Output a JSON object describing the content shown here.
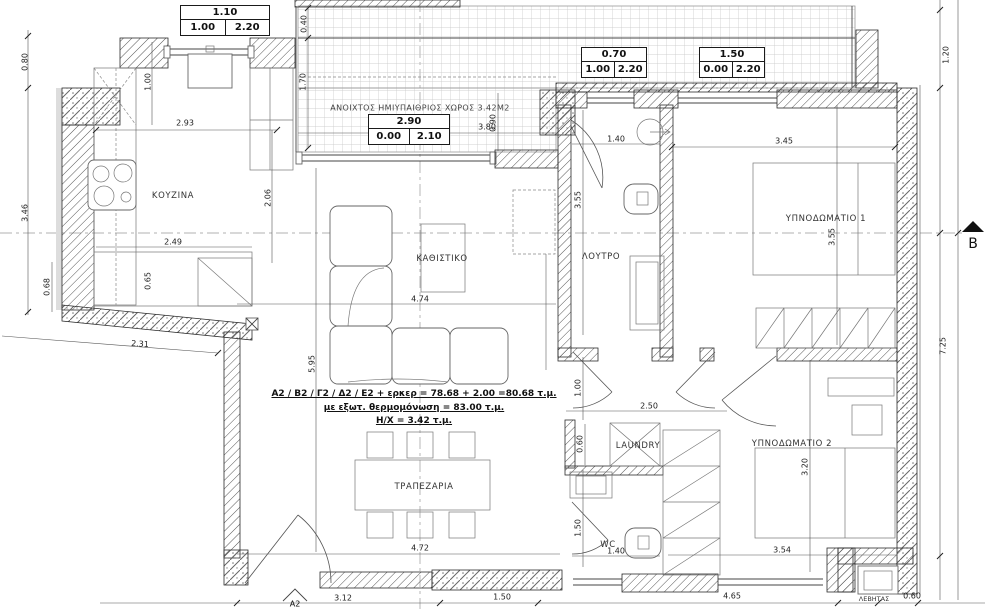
{
  "plan": {
    "pergola_label": "ΑΝΟΙΧΤΟΣ ΗΜΙΥΠΑΙΘΡΙΟΣ ΧΩΡΟΣ 3.42Μ2",
    "rooms": {
      "kitchen": "ΚΟΥΖΙΝΑ",
      "living": "ΚΑΘΙΣΤΙΚΟ",
      "bath": "ΛΟΥΤΡΟ",
      "bed1": "ΥΠΝΟΔΩΜΑΤΙΟ 1",
      "bed2": "ΥΠΝΟΔΩΜΑΤΙΟ 2",
      "dining": "ΤΡΑΠΕΖΑΡΙΑ",
      "laundry": "LAUNDRY",
      "wc": "WC",
      "boiler": "ΛΕΒΗΤΑΣ"
    },
    "boxes": {
      "b1": {
        "w": "1.10",
        "l": "1.00",
        "r": "2.20"
      },
      "b2": {
        "w": "2.90",
        "l": "0.00",
        "r": "2.10"
      },
      "b3": {
        "w": "0.70",
        "l": "1.00",
        "r": "2.20"
      },
      "b4": {
        "w": "1.50",
        "l": "0.00",
        "r": "2.20"
      }
    },
    "annotation": {
      "line1": "Α2 / Β2 / Γ2 / Δ2 / Ε2 + ερκερ = 78.68 + 2.00 =80.68 τ.μ.",
      "line2": "με εξωτ. θερμομόνωση = 83.00 τ.μ.",
      "line3": "Η/Χ = 3.42 τ.μ."
    },
    "markers": {
      "section": "B",
      "node": "A2"
    },
    "dims": {
      "d01": "2.93",
      "d02": "2.49",
      "d03": "2.31",
      "d04": "4.74",
      "d05": "3.80",
      "d06": "1.40",
      "d07": "3.45",
      "d08": "2.50",
      "d09": "1.40",
      "d10": "3.54",
      "d11": "4.72",
      "d12": "3.12",
      "d13": "1.50",
      "d14": "4.65",
      "d15": "0.60",
      "d16": "0.80",
      "d17": "3.46",
      "d18": "0.68",
      "d19": "1.00",
      "d20": "2.06",
      "d21": "5.95",
      "d22": "0.40",
      "d23": "1.70",
      "d24": "0.90",
      "d25": "3.55",
      "d26": "1.00",
      "d27": "0.60",
      "d28": "1.50",
      "d29": "0.65",
      "d30": "3.55",
      "d31": "3.20",
      "d32": "1.20",
      "d33": "7.25"
    },
    "colors": {
      "line": "#2b2b2b",
      "grid": "#c4c4c4",
      "centerline": "#999999"
    }
  }
}
